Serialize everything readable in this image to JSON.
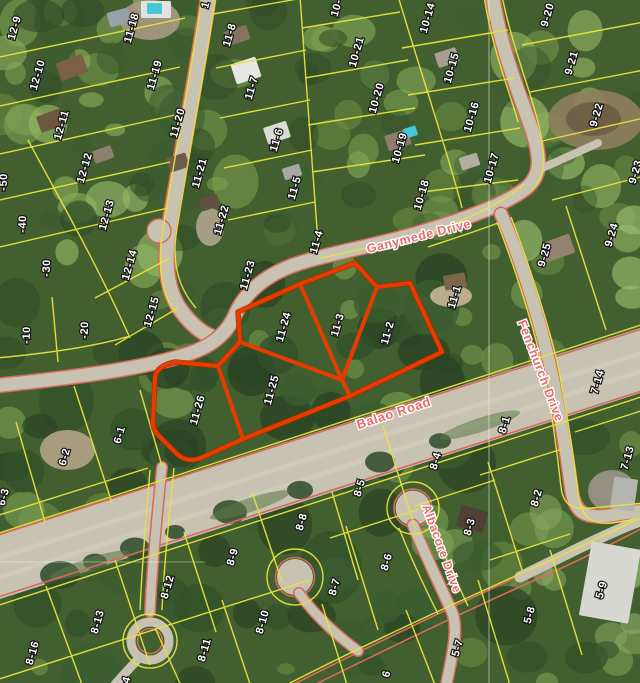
{
  "map": {
    "title": "Aerial parcel map with highlighted lots",
    "highlighted_lots": [
      "11-24",
      "11-25",
      "11-26",
      "11-3",
      "11-2"
    ],
    "roads": [
      {
        "name": "Ganymede Drive",
        "x": 419,
        "y": 237,
        "rotation": -14,
        "size": 12.5
      },
      {
        "name": "Balao Road",
        "x": 394,
        "y": 414,
        "rotation": -18,
        "size": 13
      },
      {
        "name": "Fenchurch Drive",
        "x": 540,
        "y": 371,
        "rotation": 69,
        "size": 12.5
      },
      {
        "name": "Albacore Drive",
        "x": 441,
        "y": 549,
        "rotation": 70,
        "size": 12
      }
    ],
    "parcels": [
      {
        "label": "12-9",
        "x": 15,
        "y": 28
      },
      {
        "label": "12-10",
        "x": 38,
        "y": 75
      },
      {
        "label": "12-11",
        "x": 62,
        "y": 125
      },
      {
        "label": "12-12",
        "x": 85,
        "y": 168
      },
      {
        "label": "12-13",
        "x": 107,
        "y": 215
      },
      {
        "label": "12-14",
        "x": 130,
        "y": 265
      },
      {
        "label": "12-15",
        "x": 152,
        "y": 312
      },
      {
        "label": "-50",
        "x": 4,
        "y": 182,
        "rot": -88
      },
      {
        "label": "-40",
        "x": 23,
        "y": 224,
        "rot": -88
      },
      {
        "label": "-30",
        "x": 47,
        "y": 268,
        "rot": -88
      },
      {
        "label": "-20",
        "x": 85,
        "y": 330,
        "rot": -88
      },
      {
        "label": "-10",
        "x": 27,
        "y": 335,
        "rot": -88
      },
      {
        "label": "11-18",
        "x": 132,
        "y": 28
      },
      {
        "label": "11-19",
        "x": 155,
        "y": 75
      },
      {
        "label": "11-20",
        "x": 178,
        "y": 123
      },
      {
        "label": "11-21",
        "x": 200,
        "y": 173
      },
      {
        "label": "11-22",
        "x": 222,
        "y": 220
      },
      {
        "label": "11-23",
        "x": 248,
        "y": 275
      },
      {
        "label": "1",
        "x": 206,
        "y": 5
      },
      {
        "label": "10-",
        "x": 337,
        "y": 8
      },
      {
        "label": "11-8",
        "x": 230,
        "y": 35
      },
      {
        "label": "11-7",
        "x": 252,
        "y": 88
      },
      {
        "label": "11-6",
        "x": 277,
        "y": 140
      },
      {
        "label": "11-5",
        "x": 295,
        "y": 188
      },
      {
        "label": "11-4",
        "x": 317,
        "y": 242
      },
      {
        "label": "10-21",
        "x": 357,
        "y": 52
      },
      {
        "label": "10-20",
        "x": 377,
        "y": 98
      },
      {
        "label": "10-19",
        "x": 400,
        "y": 148
      },
      {
        "label": "10-18",
        "x": 422,
        "y": 195
      },
      {
        "label": "10-14",
        "x": 428,
        "y": 18
      },
      {
        "label": "10-15",
        "x": 452,
        "y": 68
      },
      {
        "label": "10-16",
        "x": 472,
        "y": 117
      },
      {
        "label": "10-17",
        "x": 492,
        "y": 168
      },
      {
        "label": "9-20",
        "x": 548,
        "y": 15
      },
      {
        "label": "9-21",
        "x": 572,
        "y": 63
      },
      {
        "label": "9-22",
        "x": 597,
        "y": 115
      },
      {
        "label": "9-23",
        "x": 636,
        "y": 172
      },
      {
        "label": "9-25",
        "x": 545,
        "y": 255
      },
      {
        "label": "9-24",
        "x": 612,
        "y": 235
      },
      {
        "label": "11-1",
        "x": 455,
        "y": 297
      },
      {
        "label": "11-2",
        "x": 388,
        "y": 333,
        "highlighted": true
      },
      {
        "label": "11-3",
        "x": 338,
        "y": 325,
        "highlighted": true
      },
      {
        "label": "11-24",
        "x": 284,
        "y": 327,
        "highlighted": true
      },
      {
        "label": "11-25",
        "x": 272,
        "y": 390,
        "highlighted": true
      },
      {
        "label": "11-26",
        "x": 198,
        "y": 410,
        "highlighted": true
      },
      {
        "label": "7-14",
        "x": 598,
        "y": 382
      },
      {
        "label": "7-13",
        "x": 628,
        "y": 458
      },
      {
        "label": "8-1",
        "x": 505,
        "y": 425
      },
      {
        "label": "8-2",
        "x": 537,
        "y": 498
      },
      {
        "label": "8-3",
        "x": 470,
        "y": 527
      },
      {
        "label": "8-4",
        "x": 436,
        "y": 461
      },
      {
        "label": "8-5",
        "x": 360,
        "y": 488
      },
      {
        "label": "8-6",
        "x": 387,
        "y": 562
      },
      {
        "label": "8-7",
        "x": 335,
        "y": 587
      },
      {
        "label": "8-8",
        "x": 302,
        "y": 522
      },
      {
        "label": "8-9",
        "x": 233,
        "y": 557
      },
      {
        "label": "8-10",
        "x": 263,
        "y": 622
      },
      {
        "label": "8-11",
        "x": 205,
        "y": 650
      },
      {
        "label": "8-12",
        "x": 168,
        "y": 587
      },
      {
        "label": "8-13",
        "x": 98,
        "y": 622
      },
      {
        "label": "8-16",
        "x": 33,
        "y": 653
      },
      {
        "label": "4",
        "x": 127,
        "y": 680
      },
      {
        "label": "6-1",
        "x": 120,
        "y": 435
      },
      {
        "label": "6-2",
        "x": 65,
        "y": 457
      },
      {
        "label": "6-3",
        "x": 4,
        "y": 497
      },
      {
        "label": "5-9",
        "x": 602,
        "y": 590
      },
      {
        "label": "5-8",
        "x": 530,
        "y": 615
      },
      {
        "label": "5-7",
        "x": 458,
        "y": 648
      },
      {
        "label": "6",
        "x": 387,
        "y": 674
      }
    ],
    "colors": {
      "parcel_line": "#e8e33c",
      "highlight": "#e63c00",
      "road_edge": "#d96a5a",
      "road_fill": "#c7c2b2",
      "label_text": "#ffffff",
      "label_outline": "#141414",
      "road_label": "#e96a6a",
      "pool_water": "#45c8d4",
      "survey_line": "#ffffff"
    }
  }
}
